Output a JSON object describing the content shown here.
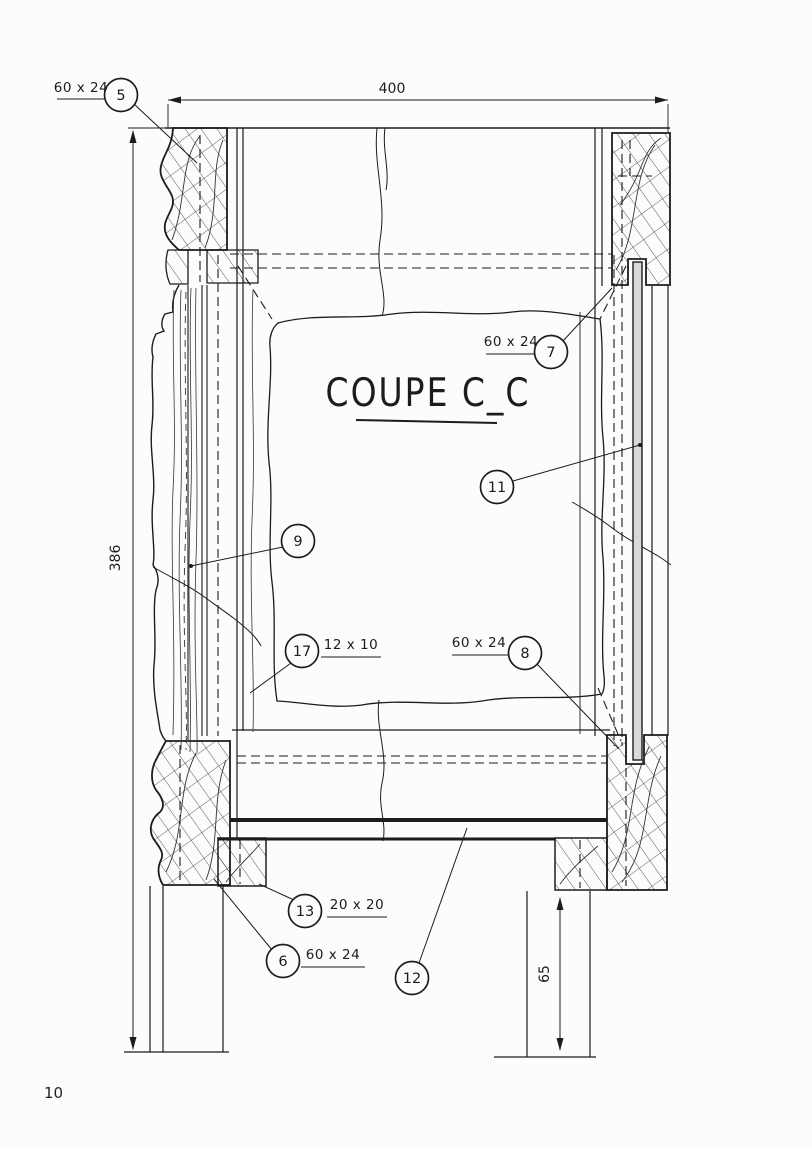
{
  "drawing": {
    "title": "COUPE C_C",
    "dimensions": {
      "top_width": "400",
      "left_height": "386",
      "right_bottom_height": "65"
    },
    "callouts": {
      "c5": {
        "number": "5",
        "label": "60 x 24"
      },
      "c6": {
        "number": "6",
        "label": "60 x 24"
      },
      "c7": {
        "number": "7",
        "label": "60 x 24"
      },
      "c8": {
        "number": "8",
        "label": "60 x 24"
      },
      "c9": {
        "number": "9"
      },
      "c11": {
        "number": "11"
      },
      "c12": {
        "number": "12"
      },
      "c13": {
        "number": "13",
        "label": "20 x 20"
      },
      "c17": {
        "number": "17",
        "label": "12 x 10"
      }
    },
    "colors": {
      "ink": "#1c1c1c",
      "paper": "#fcfcfa"
    }
  },
  "page": {
    "number": "10"
  }
}
